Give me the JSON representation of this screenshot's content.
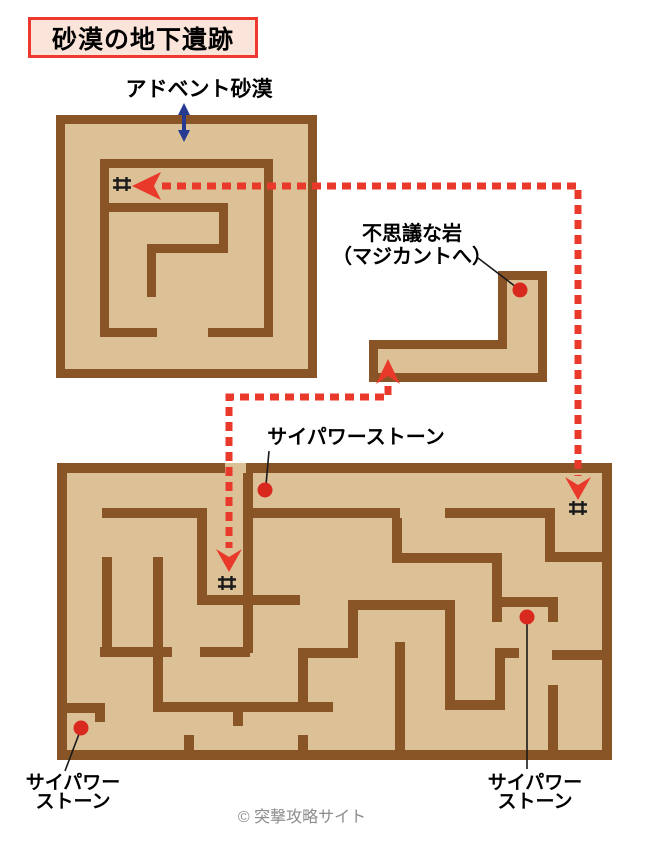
{
  "title": {
    "text": "砂漠の地下遺跡"
  },
  "labels": [
    {
      "id": "advent-desert",
      "text": "アドベント砂漠"
    },
    {
      "id": "mystery-rock",
      "text": "不思議な岩\n（マジカントへ）"
    },
    {
      "id": "psi-power-stone-top",
      "text": "サイパワーストーン"
    },
    {
      "id": "psi-power-stone-bottom-left",
      "text": "サイパワー\nストーン"
    },
    {
      "id": "psi-power-stone-bottom-right",
      "text": "サイパワー\nストーン"
    }
  ],
  "footer": {
    "copyright": "© 突撃攻略サイト"
  },
  "map": {
    "width": 652,
    "height": 856,
    "colors": {
      "wall": "#8a5526",
      "floor": "#dcc096",
      "route": "#e8392b",
      "dot": "#d9291f",
      "leader": "#1a1a1a",
      "stairs": "#1a1a1a",
      "entrance": "#263a92"
    },
    "mazes": [
      {
        "id": "upper-ruins",
        "floor": [
          56,
          115,
          261,
          263
        ],
        "walls": [
          [
            56,
            115,
            261,
            9
          ],
          [
            56,
            369,
            261,
            9
          ],
          [
            56,
            115,
            9,
            263
          ],
          [
            308,
            115,
            9,
            263
          ],
          [
            100,
            159,
            173,
            9
          ],
          [
            100,
            159,
            9,
            178
          ],
          [
            264,
            159,
            9,
            178
          ],
          [
            100,
            328,
            57,
            9
          ],
          [
            208,
            328,
            65,
            9
          ],
          [
            100,
            203,
            128,
            9
          ],
          [
            219,
            203,
            9,
            50
          ],
          [
            147,
            244,
            81,
            9
          ],
          [
            147,
            244,
            9,
            53
          ]
        ]
      },
      {
        "id": "lower-ruins",
        "floor": [
          57,
          463,
          555,
          297
        ],
        "walls": [
          [
            57,
            463,
            168,
            10
          ],
          [
            246,
            463,
            366,
            10
          ],
          [
            57,
            750,
            555,
            10
          ],
          [
            57,
            463,
            10,
            297
          ],
          [
            602,
            463,
            10,
            297
          ],
          [
            102,
            508,
            105,
            10
          ],
          [
            197,
            508,
            10,
            97
          ],
          [
            197,
            595,
            103,
            10
          ],
          [
            243,
            473,
            10,
            180
          ],
          [
            252,
            508,
            148,
            10
          ],
          [
            445,
            508,
            110,
            10
          ],
          [
            545,
            508,
            10,
            54
          ],
          [
            545,
            552,
            62,
            10
          ],
          [
            392,
            518,
            10,
            45
          ],
          [
            392,
            553,
            108,
            10
          ],
          [
            492,
            553,
            10,
            69
          ],
          [
            502,
            597,
            56,
            10
          ],
          [
            548,
            597,
            10,
            25
          ],
          [
            552,
            650,
            55,
            10
          ],
          [
            548,
            685,
            10,
            70
          ],
          [
            495,
            648,
            24,
            10
          ],
          [
            495,
            648,
            10,
            62
          ],
          [
            445,
            700,
            60,
            10
          ],
          [
            445,
            607,
            10,
            103
          ],
          [
            348,
            600,
            107,
            10
          ],
          [
            348,
            600,
            10,
            58
          ],
          [
            395,
            642,
            10,
            113
          ],
          [
            298,
            648,
            60,
            10
          ],
          [
            298,
            648,
            10,
            64
          ],
          [
            153,
            702,
            180,
            10
          ],
          [
            233,
            712,
            10,
            14
          ],
          [
            153,
            557,
            10,
            155
          ],
          [
            102,
            557,
            10,
            91
          ],
          [
            100,
            647,
            72,
            10
          ],
          [
            200,
            647,
            50,
            10
          ],
          [
            58,
            703,
            47,
            10
          ],
          [
            95,
            703,
            10,
            19
          ],
          [
            184,
            735,
            10,
            20
          ],
          [
            298,
            735,
            10,
            20
          ]
        ]
      }
    ],
    "rooms": [
      {
        "id": "mystery-rock-room",
        "outer": "498,271 547,271 547,382 369,382 369,340 498,340",
        "inner": "507,280 538,280 538,373 378,373 378,349 507,349"
      }
    ],
    "leader_lines": [
      [
        [
          269,
          451
        ],
        [
          266,
          485
        ]
      ],
      [
        [
          478,
          258
        ],
        [
          516,
          287
        ]
      ],
      [
        [
          527,
          624
        ],
        [
          527,
          769
        ]
      ],
      [
        [
          79,
          734
        ],
        [
          65,
          771
        ]
      ]
    ],
    "routes": [
      {
        "id": "route-upper",
        "points": [
          [
            162,
            186
          ],
          [
            578,
            186
          ],
          [
            578,
            476
          ]
        ]
      },
      {
        "id": "route-lower",
        "points": [
          [
            388,
            386
          ],
          [
            388,
            397
          ],
          [
            229,
            397
          ],
          [
            229,
            548
          ]
        ]
      }
    ],
    "arrowheads": [
      {
        "id": "into-upper-ruins",
        "points": "161,172 154,186 161,200 132,186"
      },
      {
        "id": "down-right-entry",
        "points": "565,477 578,485 591,477 578,500"
      },
      {
        "id": "down-mid-entry",
        "points": "216,549 229,557 242,549 229,572"
      },
      {
        "id": "up-into-rock-room",
        "points": "376,384 388,376 400,384 388,359"
      }
    ],
    "entrance_arrow": {
      "x": 184,
      "y1": 103,
      "y2": 142
    },
    "dots": [
      {
        "id": "mystery-rock",
        "x": 520,
        "y": 290
      },
      {
        "id": "psi-stone-top",
        "x": 265,
        "y": 490
      },
      {
        "id": "psi-stone-right",
        "x": 527,
        "y": 617
      },
      {
        "id": "psi-stone-left",
        "x": 81,
        "y": 728
      }
    ],
    "stairs": [
      {
        "id": "upper-stairs",
        "x": 122,
        "y": 184
      },
      {
        "id": "lower-right-stairs",
        "x": 578,
        "y": 508
      },
      {
        "id": "lower-mid-stairs",
        "x": 227,
        "y": 583
      }
    ]
  }
}
